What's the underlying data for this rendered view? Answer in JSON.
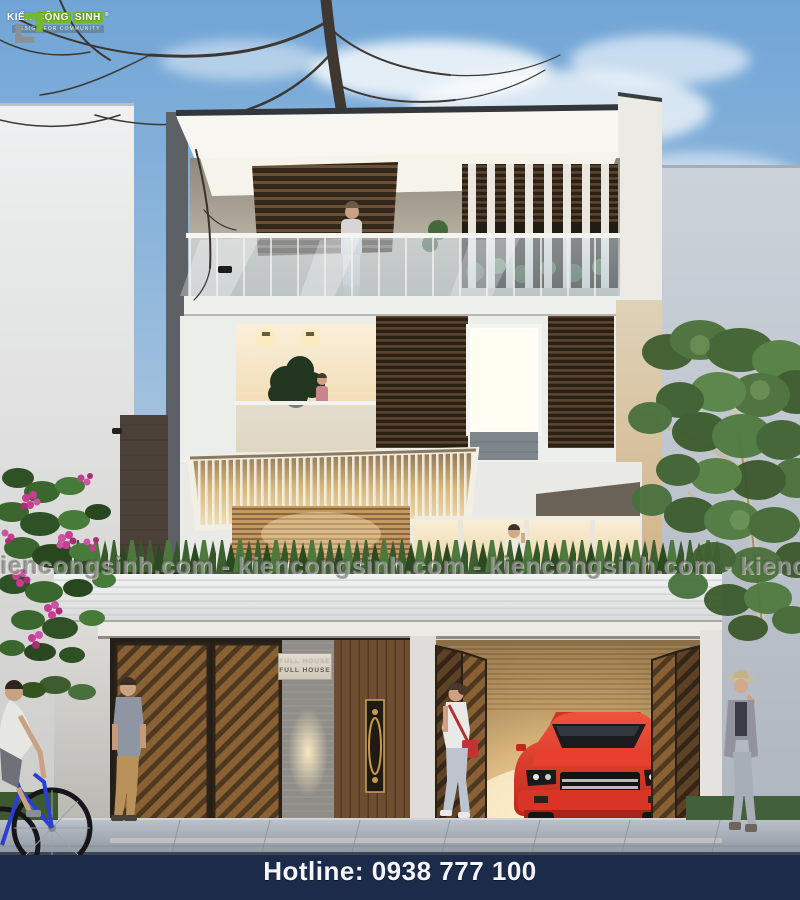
{
  "branding": {
    "logo_title_parts": [
      "KIẾN",
      "CỘNG",
      "SINH"
    ],
    "registered_mark": "®",
    "logo_subtitle": "DESIGN FOR COMMUNITY",
    "brand_green": "#76b82a",
    "brand_gray": "#8b9096"
  },
  "watermark": {
    "unit": "kiencongsinh.com",
    "line": "kiencongsinh.com - kiencongsinh.com - kiencongsinh.com - kiencongsinh.com - kiencongsinh.com"
  },
  "building": {
    "sign_text": "FULL HOUSE"
  },
  "footer": {
    "hotline": "Hotline: 0938 777 100",
    "bar_color": "#1d2b4b",
    "text_color": "#f4f6fa"
  },
  "palette": {
    "sky_top": "#70a5d6",
    "sky_bottom": "#dee3e8",
    "left_wall": "#e8eaec",
    "right_wall": "#c3c9d2",
    "house_white": "#f2f1ed",
    "wood_dark": "#4a3827",
    "wood_warm": "#c59a60",
    "interior_glow": "#f8ecd2",
    "hedge_green": "#41682f",
    "car_red": "#e03428",
    "sidewalk": "#a6aeb8",
    "flower_pink": "#c83d92"
  }
}
